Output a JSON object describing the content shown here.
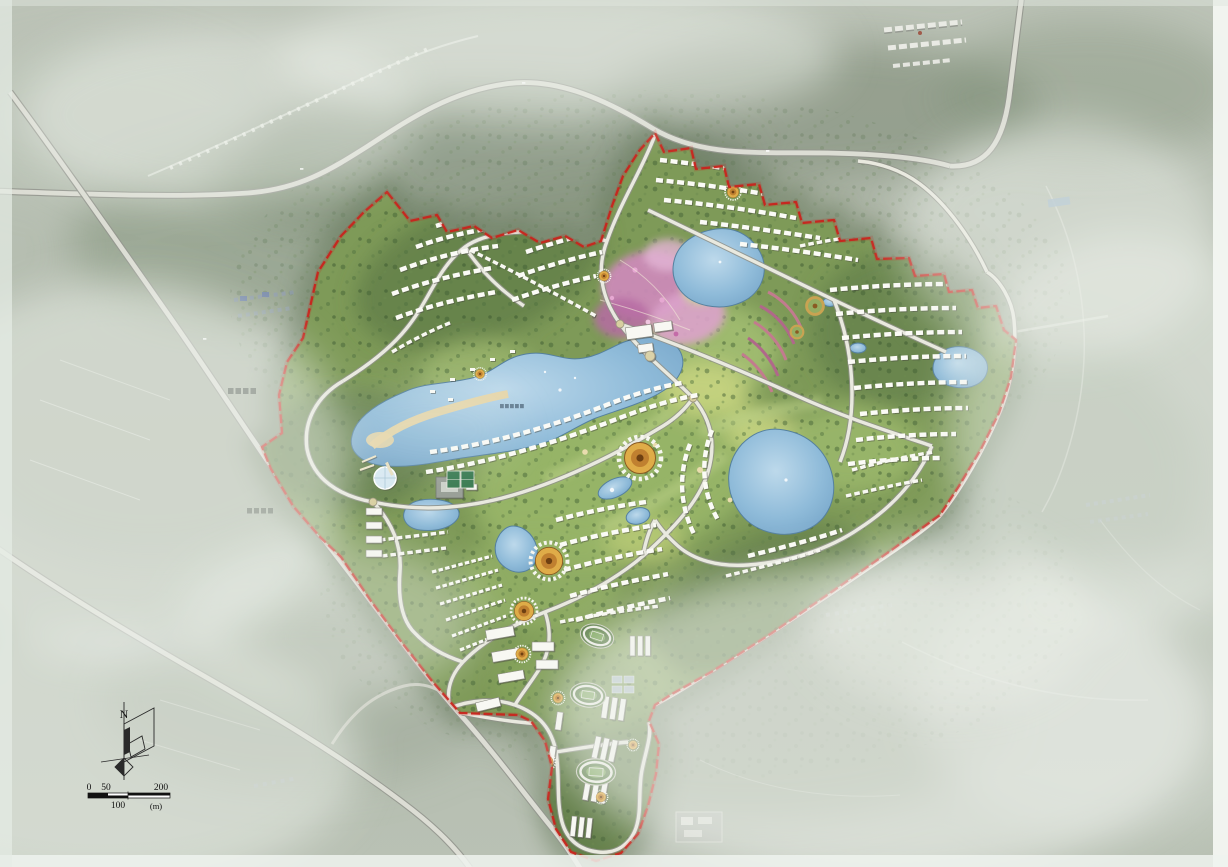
{
  "canvas": {
    "width": 1228,
    "height": 867
  },
  "compass": {
    "label": "N"
  },
  "scale_bar": {
    "t0": "0",
    "t50": "50",
    "t100": "100",
    "t200": "200",
    "unit": "(m)"
  },
  "palette": {
    "boundary_red": "#c9241c",
    "context_base": "#b7bfb2",
    "fog": "#e9ede8",
    "forest_dark": "#4d683c",
    "site_green": "#7e9a58",
    "lawn_light": "#a7c173",
    "water": "#85b5d6",
    "water_edge": "#5b83a0",
    "beach_sand": "#e6d3a4",
    "road_fill": "#e7e7de",
    "road_casing": "#97998f",
    "building_white": "#f8f8f3",
    "plaza_gold": "#d9a33c",
    "flower_pink": "#cf8abc",
    "track_green": "#7fa75f"
  },
  "features": {
    "boundary": "red dashed planning boundary",
    "lakes": [
      "central lake",
      "north lake",
      "east lake",
      "southwest ponds",
      "northeast pond"
    ],
    "plazas": [
      "sunflower plaza central",
      "sunflower plaza south-west large",
      "sunflower plaza south-west small",
      "entry circle north",
      "ring gardens"
    ],
    "zones": [
      "northwest villas",
      "north ridge villas",
      "northeast villas",
      "lakefront villas",
      "central south villas",
      "southwest terraced villas",
      "east villas",
      "school campus tail"
    ],
    "landmarks": [
      "glass dome pavilion",
      "resort core buildings",
      "lakeside hotel",
      "pink flower garden",
      "beach",
      "running tracks",
      "tennis courts"
    ]
  }
}
